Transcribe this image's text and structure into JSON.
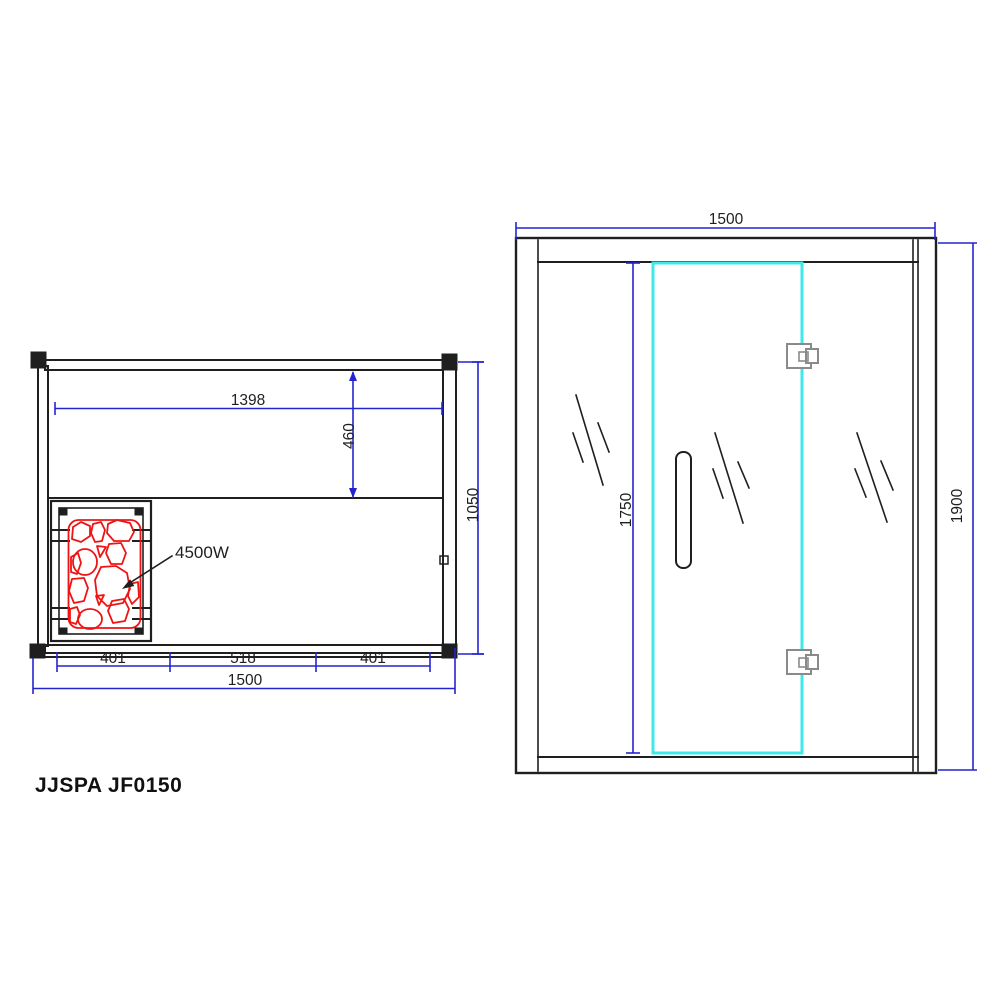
{
  "drawing": {
    "model_label": "JJSPA JF0150"
  },
  "colors": {
    "line": "#1f1f1f",
    "dimension_blue": "#2424cf",
    "door_cyan": "#3de9e9",
    "heater_red": "#ee1414",
    "hinge_gray": "#8a8a8a"
  },
  "plan_view": {
    "dims": {
      "inner_width": "1398",
      "bench_depth": "460",
      "overall_depth": "1050",
      "front_left": "401",
      "front_center": "518",
      "front_right": "401",
      "overall_width": "1500"
    },
    "heater_power": "4500W"
  },
  "front_view": {
    "dims": {
      "overall_width": "1500",
      "door_height": "1750",
      "overall_height": "1900"
    }
  }
}
